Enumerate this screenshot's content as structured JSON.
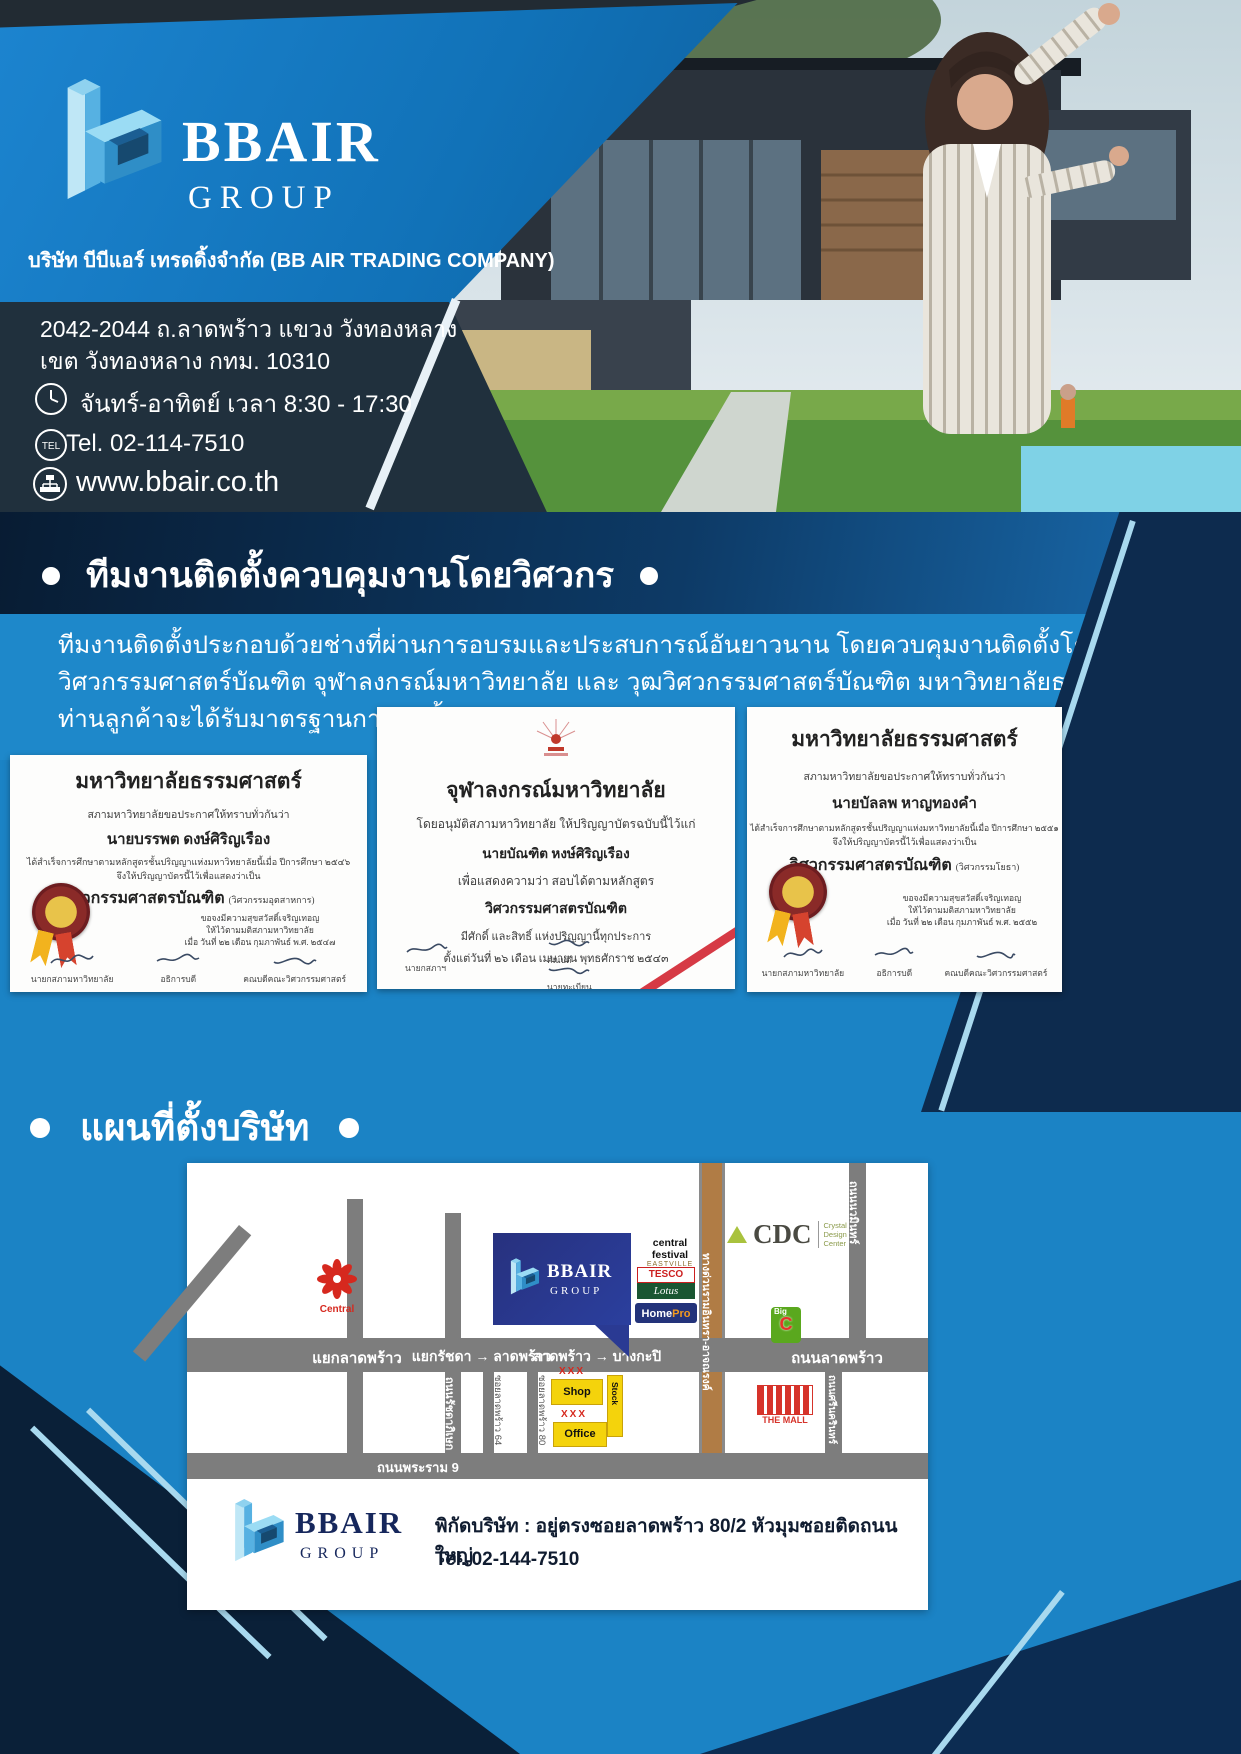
{
  "brand": {
    "name": "BBAIR",
    "group": "GROUP"
  },
  "header": {
    "company_line": "บริษัท บีบีแอร์ เทรดดิ้งจำกัด (BB AIR TRADING COMPANY)",
    "address1": "2042-2044 ถ.ลาดพร้าว แขวง วังทองหลาง",
    "address2": "เขต วังทองหลาง กทม. 10310",
    "hours": "จันทร์-อาทิตย์ เวลา 8:30 - 17:30",
    "tel": "Tel. 02-114-7510",
    "tel_icon": "TEL",
    "website": "www.bbair.co.th"
  },
  "team_section": {
    "heading": "ทีมงานติดตั้งควบคุมงานโดยวิศวกร",
    "paragraph": "ทีมงานติดตั้งประกอบด้วยช่างที่ผ่านการอบรมและประสบการณ์อันยาวนาน โดยควบคุมงานติดตั้งโดยวุฒิวิศวกรรมศาสตร์บัณฑิต จุฬาลงกรณ์มหาวิทยาลัย และ วุฒวิศวกรรมศาสตร์บัณฑิต มหาวิทยาลัยธรรมศาตร์ ท่านลูกค้าจะได้รับมาตรฐานการติดตั้งอย่างสูงสุด"
  },
  "map_section": {
    "heading": "แผนที่ตั้งบริษัท"
  },
  "certificates": [
    {
      "university": "มหาวิทยาลัยธรรมศาสตร์",
      "proclaim": "สภามหาวิทยาลัยขอประกาศให้ทราบทั่วกันว่า",
      "name": "นายบรรพต ดงษ์ศิริญเรือง",
      "completed": "ได้สำเร็จการศึกษาตามหลักสูตรชั้นปริญญาแห่งมหาวิทยาลัยนี้เมื่อ ปีการศึกษา ๒๕๔๖",
      "grant": "จึงให้ปริญญาบัตรนี้ไว้เพื่อแสดงว่าเป็น",
      "degree": "วิศวกรรมศาสตรบัณฑิต",
      "major": "(วิศวกรรมอุตสาหการ)",
      "blessing": "ขอจงมีความสุขสวัสดิ์เจริญเทอญ",
      "given": "ให้ไว้ตามมติสภามหาวิทยาลัย",
      "date": "เมื่อ วันที่ ๒๒ เดือน กุมภาพันธ์ พ.ศ. ๒๕๔๗",
      "signers": [
        "นายกสภามหาวิทยาลัย",
        "อธิการบดี",
        "คณบดีคณะวิศวกรรมศาสตร์"
      ]
    },
    {
      "university": "จุฬาลงกรณ์มหาวิทยาลัย",
      "line1": "โดยอนุมัติสภามหาวิทยาลัย ให้ปริญญาบัตรฉบับนี้ไว้แก่",
      "name": "นายบัณฑิต หงษ์ศิริญเรือง",
      "line2": "เพื่อแสดงความว่า สอบได้ตามหลักสูตร",
      "degree": "วิศวกรรมศาสตรบัณฑิต",
      "line3": "มีศักดิ์ และสิทธิ์ แห่งปริญญานี้ทุกประการ",
      "line4": "ตั้งแต่วันที่ ๒๖ เดือน เมษายน พุทธศักราช ๒๕๔๓",
      "signers": [
        "นายกสภาฯ",
        "คณบดี",
        "นายทะเบียน"
      ]
    },
    {
      "university": "มหาวิทยาลัยธรรมศาสตร์",
      "proclaim": "สภามหาวิทยาลัยขอประกาศให้ทราบทั่วกันว่า",
      "name": "นายบัลลพ หาญทองคำ",
      "completed": "ได้สำเร็จการศึกษาตามหลักสูตรชั้นปริญญาแห่งมหาวิทยาลัยนี้เมื่อ ปีการศึกษา ๒๕๕๑",
      "grant": "จึงให้ปริญญาบัตรนี้ไว้เพื่อแสดงว่าเป็น",
      "degree": "วิศวกรรมศาสตรบัณฑิต",
      "major": "(วิศวกรรมโยธา)",
      "blessing": "ขอจงมีความสุขสวัสดิ์เจริญเทอญ",
      "given": "ให้ไว้ตามมติสภามหาวิทยาลัย",
      "date": "เมื่อ วันที่ ๒๒ เดือน กุมภาพันธ์ พ.ศ. ๒๕๕๒",
      "signers": [
        "นายกสภามหาวิทยาลัย",
        "อธิการบดี",
        "คณบดีคณะวิศวกรรมศาสตร์"
      ]
    }
  ],
  "map_card": {
    "junctions": [
      "แยกลาดพร้าว",
      "แยกรัชดา → ลาดพร้าว",
      "ลาดพร้าว → บางกะปิ",
      "ถนนลาดพร้าว"
    ],
    "roads": {
      "rachada": "ถนนรัชดาภิเษก",
      "expressway": "ทางด่วนรามอินทรา-อาจณรงค์",
      "nawamin": "ถนนนวมินทร์",
      "srinakarin": "ถนนศรีนครินทร์",
      "rama9": "ถนนพระราม 9",
      "soi64": "ซอยลาดพร้าว 64",
      "soi80": "ซอยลาดพร้าว 80"
    },
    "landmarks": {
      "central": "Central",
      "central_festival": "central festival",
      "central_festival_sub": "EASTVILLE",
      "tesco": "TESCO",
      "lotus": "Lotus",
      "homepro_home": "Home",
      "homepro_pro": "Pro",
      "cdc": "CDC",
      "cdc_sub": "Crystal Design Center",
      "bigc_big": "Big",
      "bigc_c": "C",
      "themall": "THE MALL",
      "shop": "Shop",
      "stock": "Stock",
      "office": "Office",
      "xxx": "XXX"
    },
    "footer": {
      "label": "พิกัดบริษัท :",
      "address": "อยู่ตรงซอยลาดพร้าว 80/2 หัวมุมซอยติดถนนใหญ่",
      "tel": "Tel. 02-144-7510"
    }
  },
  "colors": {
    "brand_blue": "#1779c2",
    "navy": "#0c2440",
    "light_blue_logo": "#8fd2ef",
    "map_box_blue": "#27317e",
    "accent_yellow": "#f4d30c",
    "accent_red": "#d6281e"
  }
}
